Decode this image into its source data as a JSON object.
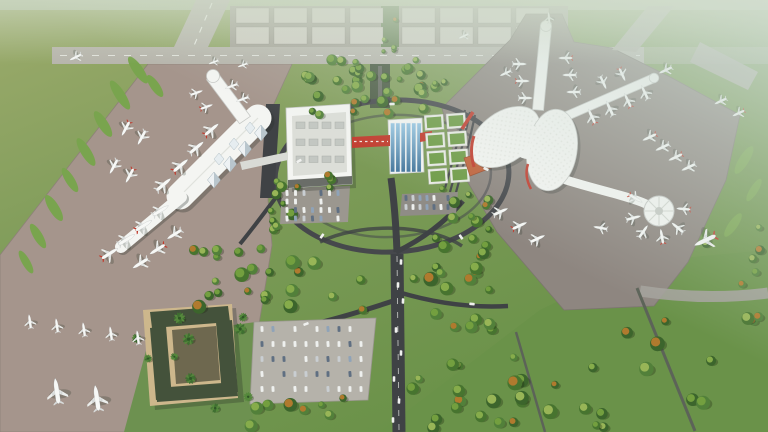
{
  "title": "Aerial rendering of an airport campus: left linear terminal and right Y-shaped terminal with round satellite, cargo apron and runway at top, central wooded landside with road interchange, hotel and parking at bottom",
  "palette": {
    "grass-base": "#7d9b58",
    "grass-tl": "#9cab6c",
    "lawn-br": "#6a9249",
    "grass-island": "#79a44e",
    "apron-l": "#a5958c",
    "apron-r": "#8e8680",
    "runway": "#b7b5ac",
    "cargo-base": "#a5a298",
    "cargo-block": "#d0cdc4",
    "road": "#3f4245",
    "loop": "#46484c",
    "term-white": "#f4f5f2",
    "term-edge": "#c7c9c6",
    "accent-red": "#c23a2c",
    "blue-glass": "#6ea6cd",
    "green-roof": "#6f9c47",
    "roof-frame": "#e9ebe5",
    "orange-roof": "#c0613a",
    "hotel-tan": "#cdb78c",
    "hotel-roof": "#44523b",
    "park-lot": "#b5b2aa"
  },
  "seed": 11,
  "cargo_apron": {
    "clusters": [
      236,
      402
    ],
    "cols": 4,
    "block_w": 33,
    "gap": 5,
    "rows": [
      {
        "y": 8,
        "h": 15
      },
      {
        "y": 27,
        "h": 17
      }
    ]
  },
  "aircraft": [
    [
      30,
      322,
      -8,
      0.75,
      "w"
    ],
    [
      57,
      326,
      -8,
      0.75,
      "w"
    ],
    [
      84,
      330,
      -8,
      0.75,
      "w"
    ],
    [
      111,
      334,
      -8,
      0.75,
      "w"
    ],
    [
      138,
      338,
      -8,
      0.75,
      "w"
    ],
    [
      57,
      392,
      -8,
      1.35,
      "w"
    ],
    [
      97,
      399,
      -8,
      1.35,
      "w"
    ],
    [
      109,
      254,
      58,
      1,
      "r"
    ],
    [
      126,
      240,
      58,
      1,
      "w"
    ],
    [
      143,
      226,
      58,
      1,
      "r"
    ],
    [
      160,
      211,
      58,
      0.95,
      "w"
    ],
    [
      141,
      263,
      238,
      0.95,
      "w"
    ],
    [
      158,
      249,
      238,
      0.95,
      "r"
    ],
    [
      175,
      234,
      238,
      0.9,
      "w"
    ],
    [
      163,
      185,
      50,
      1,
      "w"
    ],
    [
      180,
      166,
      50,
      1,
      "r"
    ],
    [
      196,
      148,
      50,
      0.95,
      "w"
    ],
    [
      211,
      130,
      50,
      0.95,
      "r"
    ],
    [
      196,
      93,
      70,
      0.7,
      "w"
    ],
    [
      206,
      107,
      70,
      0.7,
      "r"
    ],
    [
      232,
      86,
      250,
      0.7,
      "w"
    ],
    [
      243,
      99,
      250,
      0.7,
      "w"
    ],
    [
      126,
      128,
      208,
      0.85,
      "r"
    ],
    [
      142,
      137,
      208,
      0.85,
      "w"
    ],
    [
      114,
      166,
      208,
      0.85,
      "w"
    ],
    [
      130,
      175,
      208,
      0.85,
      "r"
    ],
    [
      76,
      57,
      244,
      0.7,
      "w"
    ],
    [
      214,
      62,
      250,
      0.55,
      "w"
    ],
    [
      243,
      65,
      250,
      0.55,
      "w"
    ],
    [
      519,
      64,
      90,
      0.75,
      "w"
    ],
    [
      522,
      81,
      90,
      0.75,
      "r"
    ],
    [
      525,
      98,
      90,
      0.75,
      "w"
    ],
    [
      566,
      58,
      270,
      0.75,
      "r"
    ],
    [
      570,
      75,
      270,
      0.75,
      "w"
    ],
    [
      574,
      92,
      270,
      0.75,
      "w"
    ],
    [
      549,
      18,
      355,
      0.6,
      "w"
    ],
    [
      592,
      117,
      335,
      0.85,
      "r"
    ],
    [
      610,
      109,
      335,
      0.85,
      "w"
    ],
    [
      628,
      101,
      335,
      0.8,
      "r"
    ],
    [
      645,
      93,
      335,
      0.8,
      "w"
    ],
    [
      603,
      82,
      155,
      0.75,
      "w"
    ],
    [
      622,
      74,
      155,
      0.75,
      "r"
    ],
    [
      666,
      70,
      245,
      0.75,
      "w"
    ],
    [
      635,
      198,
      120,
      0.8,
      "r"
    ],
    [
      633,
      218,
      75,
      0.8,
      "w"
    ],
    [
      643,
      232,
      35,
      0.8,
      "w"
    ],
    [
      662,
      237,
      350,
      0.8,
      "r"
    ],
    [
      678,
      228,
      310,
      0.8,
      "w"
    ],
    [
      684,
      209,
      275,
      0.75,
      "r"
    ],
    [
      650,
      137,
      245,
      0.8,
      "r"
    ],
    [
      663,
      147,
      245,
      0.8,
      "w"
    ],
    [
      676,
      157,
      245,
      0.8,
      "r"
    ],
    [
      689,
      167,
      245,
      0.8,
      "w"
    ],
    [
      706,
      240,
      245,
      1.25,
      "r"
    ],
    [
      500,
      212,
      65,
      0.85,
      "w"
    ],
    [
      519,
      226,
      65,
      0.85,
      "r"
    ],
    [
      537,
      239,
      65,
      0.85,
      "w"
    ],
    [
      601,
      228,
      280,
      0.75,
      "w"
    ],
    [
      721,
      101,
      245,
      0.7,
      "w"
    ],
    [
      739,
      113,
      245,
      0.7,
      "r"
    ],
    [
      506,
      73,
      245,
      0.65,
      "w"
    ],
    [
      464,
      36,
      245,
      0.6,
      "w"
    ]
  ],
  "tree_regions": [
    {
      "x0": 294,
      "y0": 58,
      "x1": 445,
      "y1": 92,
      "n": 26,
      "rmin": 3,
      "rmax": 6.5,
      "kind": "mixed"
    },
    {
      "x0": 300,
      "y0": 92,
      "x1": 440,
      "y1": 118,
      "n": 12,
      "rmin": 3,
      "rmax": 6,
      "kind": "mixed"
    },
    {
      "x0": 268,
      "y0": 150,
      "x1": 332,
      "y1": 235,
      "n": 13,
      "rmin": 3,
      "rmax": 6,
      "kind": "mixed"
    },
    {
      "x0": 430,
      "y0": 185,
      "x1": 492,
      "y1": 245,
      "n": 10,
      "rmin": 3,
      "rmax": 6,
      "kind": "mixed"
    },
    {
      "x0": 185,
      "y0": 248,
      "x1": 390,
      "y1": 316,
      "n": 24,
      "rmin": 3.5,
      "rmax": 7.5,
      "kind": "mixed"
    },
    {
      "x0": 250,
      "y0": 398,
      "x1": 374,
      "y1": 428,
      "n": 8,
      "rmin": 3.5,
      "rmax": 7,
      "kind": "mixed"
    },
    {
      "x0": 412,
      "y0": 238,
      "x1": 500,
      "y1": 310,
      "n": 14,
      "rmin": 3.5,
      "rmax": 7.5,
      "kind": "mixed"
    },
    {
      "x0": 412,
      "y0": 310,
      "x1": 560,
      "y1": 428,
      "n": 26,
      "rmin": 3.5,
      "rmax": 7.5,
      "kind": "mixed"
    },
    {
      "x0": 585,
      "y0": 300,
      "x1": 762,
      "y1": 428,
      "n": 15,
      "rmin": 4,
      "rmax": 8,
      "kind": "mixed"
    },
    {
      "x0": 695,
      "y0": 215,
      "x1": 765,
      "y1": 288,
      "n": 6,
      "rmin": 3,
      "rmax": 5,
      "kind": "mixed"
    },
    {
      "x0": 135,
      "y0": 302,
      "x1": 250,
      "y1": 415,
      "n": 10,
      "rmin": 3,
      "rmax": 5,
      "kind": "palm"
    },
    {
      "x0": 381,
      "y0": 10,
      "x1": 396,
      "y1": 52,
      "n": 5,
      "rmin": 2,
      "rmax": 3.5,
      "kind": "mixed"
    }
  ],
  "parking_lots": [
    {
      "name": "main-parking",
      "x": 262,
      "y": 329,
      "rows": 5,
      "cols": 10,
      "dx": 11,
      "dy": 15,
      "rot": -3
    },
    {
      "name": "gtc-west-parking",
      "x": 287,
      "y": 193,
      "rows": 4,
      "cols": 7,
      "dx": 8.5,
      "dy": 8.5,
      "rot": -3
    },
    {
      "name": "bus-staging",
      "x": 406,
      "y": 198,
      "rows": 2,
      "cols": 7,
      "dx": 7,
      "dy": 9,
      "rot": -3
    }
  ],
  "road_vehicles": [
    {
      "x": 401,
      "y": 262,
      "rot": 2
    },
    {
      "x": 398,
      "y": 285,
      "rot": 1
    },
    {
      "x": 403,
      "y": 301,
      "rot": 3
    },
    {
      "x": 396,
      "y": 330,
      "rot": 0
    },
    {
      "x": 401,
      "y": 353,
      "rot": 2
    },
    {
      "x": 394,
      "y": 379,
      "rot": 1
    },
    {
      "x": 399,
      "y": 401,
      "rot": 3
    },
    {
      "x": 393,
      "y": 420,
      "rot": 0
    },
    {
      "x": 392,
      "y": 104,
      "rot": 88
    },
    {
      "x": 299,
      "y": 161,
      "rot": 60
    },
    {
      "x": 486,
      "y": 169,
      "rot": 115
    },
    {
      "x": 322,
      "y": 236,
      "rot": 35
    },
    {
      "x": 461,
      "y": 237,
      "rot": 145
    },
    {
      "x": 306,
      "y": 324,
      "rot": 70
    },
    {
      "x": 472,
      "y": 304,
      "rot": 95
    }
  ]
}
